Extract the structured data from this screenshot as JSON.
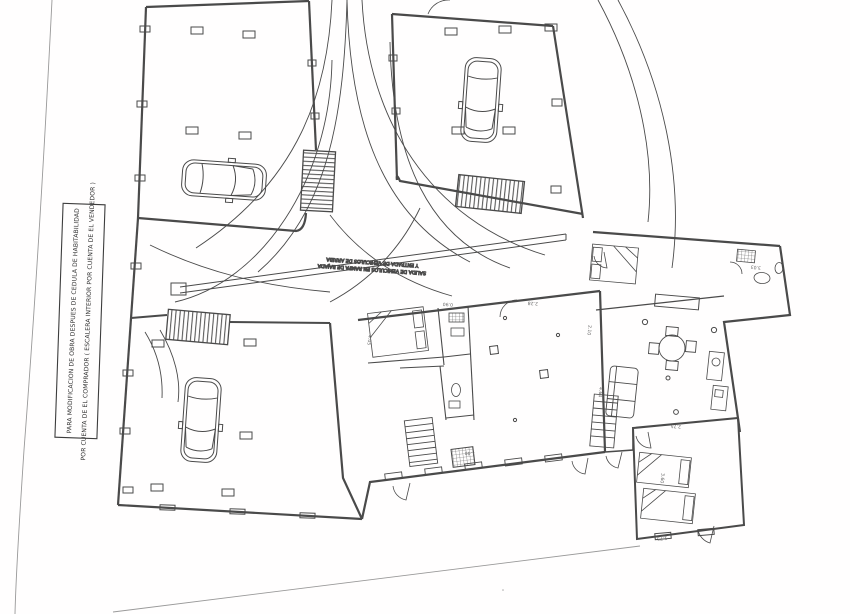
{
  "annotation_box": {
    "line1": "PARA MODIFICACION DE OBRA DESPUES DE CEDULA DE HABITABILIDAD",
    "line2": "POR CUENTA DE EL COMPRADOR ( ESCALERA INTERIOR POR CUENTA DE EL VENDEDOR )"
  },
  "driveway_label": {
    "line1": "SALIDA DE VEHICULOS EN RAMPA DE BAJADA",
    "line2": "Y ENTRADA DE VEHICULOS DE ARRIBA"
  },
  "dimensions": [
    "2.28",
    "4.05",
    "3.60",
    "1.75",
    "4.64",
    "0.90",
    "2.10",
    "3.03",
    "2.75",
    "1.40"
  ],
  "icons": {
    "car": "top-view-car-icon",
    "ramp": "hatched-ramp-icon",
    "stairs": "staircase-icon",
    "door": "door-swing-icon",
    "bed": "bed-icon",
    "table": "dining-table-icon",
    "sofa": "sofa-icon",
    "toilet": "toilet-icon"
  },
  "colors": {
    "paper": "#fffefe",
    "line": "#4a4a4a",
    "faint": "#999999"
  }
}
